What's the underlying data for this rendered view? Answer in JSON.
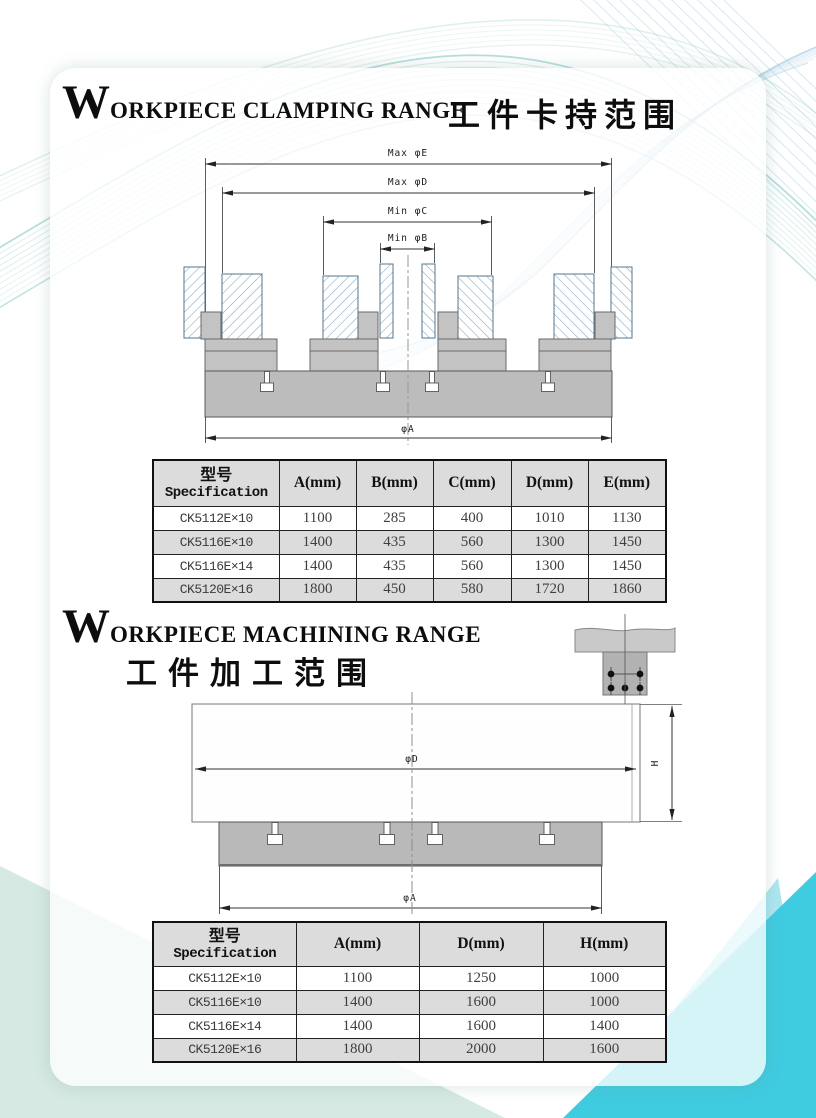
{
  "headings": {
    "clamping": {
      "initial": "W",
      "rest": "ORKPIECE CLAMPING RANGE",
      "zh": "工件卡持范围"
    },
    "machining": {
      "initial": "W",
      "rest": "ORKPIECE MACHINING RANGE",
      "zh": "工件加工范围"
    }
  },
  "clamping_diagram": {
    "labels": {
      "max_e": "Max φE",
      "max_d": "Max φD",
      "min_c": "Min φC",
      "min_b": "Min φB",
      "phi_a": "φA"
    }
  },
  "machining_diagram": {
    "labels": {
      "phi_d": "φD",
      "h": "H",
      "phi_a": "φA"
    }
  },
  "clamping_table": {
    "header": {
      "spec_zh": "型号",
      "spec_en": "Specification",
      "cols": [
        "A(mm)",
        "B(mm)",
        "C(mm)",
        "D(mm)",
        "E(mm)"
      ]
    },
    "rows": [
      {
        "model": "CK5112E×10",
        "a": "1100",
        "b": "285",
        "c": "400",
        "d": "1010",
        "e": "1130"
      },
      {
        "model": "CK5116E×10",
        "a": "1400",
        "b": "435",
        "c": "560",
        "d": "1300",
        "e": "1450"
      },
      {
        "model": "CK5116E×14",
        "a": "1400",
        "b": "435",
        "c": "560",
        "d": "1300",
        "e": "1450"
      },
      {
        "model": "CK5120E×16",
        "a": "1800",
        "b": "450",
        "c": "580",
        "d": "1720",
        "e": "1860"
      }
    ]
  },
  "machining_table": {
    "header": {
      "spec_zh": "型号",
      "spec_en": "Specification",
      "cols": [
        "A(mm)",
        "D(mm)",
        "H(mm)"
      ]
    },
    "rows": [
      {
        "model": "CK5112E×10",
        "a": "1100",
        "d": "1250",
        "h": "1000"
      },
      {
        "model": "CK5116E×10",
        "a": "1400",
        "d": "1600",
        "h": "1000"
      },
      {
        "model": "CK5116E×14",
        "a": "1400",
        "d": "1600",
        "h": "1400"
      },
      {
        "model": "CK5120E×16",
        "a": "1800",
        "d": "2000",
        "h": "1600"
      }
    ]
  },
  "colors": {
    "swirl_teal": "#7cc2bd",
    "swirl_blue": "#86b9d6",
    "swirl_pale": "#b9ddd2",
    "mint": "#d6e9e3",
    "cyan_bright": "#3fcbe0",
    "cyan_light": "#aee6f0",
    "table_shade": "#dcdcdc",
    "metal_gray": "#bdbdbd",
    "hatch_blue": "#7fa6bf"
  }
}
